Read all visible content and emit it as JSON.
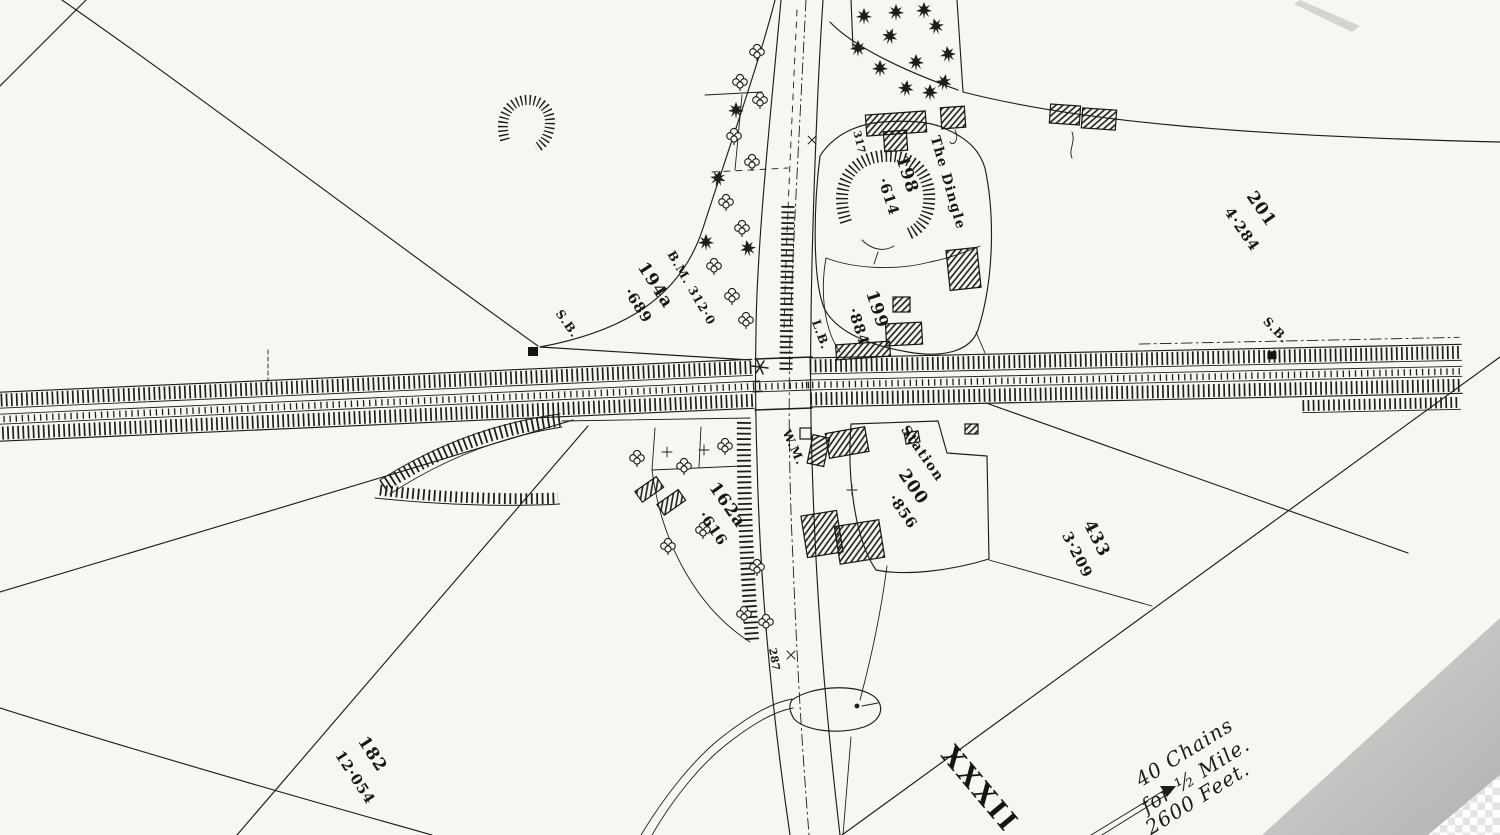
{
  "labels": {
    "dingle_name": "The Dingle",
    "dingle_no": "198",
    "dingle_area": "·614",
    "bench_mark": "B.M. 312·0",
    "p194_no": "194a",
    "p194_area": "·689",
    "sb_left": "S.B.",
    "sb_right": "S.B.",
    "lb": "L.B.",
    "wm": "W.M.",
    "n317": "317",
    "n287": "287",
    "p199_no": "199",
    "p199_area": "·884",
    "p201_no": "201",
    "p201_area": "4·284",
    "station": "Station",
    "p200_no": "200",
    "p200_area": "·856",
    "p433_no": "433",
    "p433_area": "3·209",
    "p162_no": "162a",
    "p162_area": "·616",
    "p182_no": "182",
    "p182_area": "12·054",
    "sheet_no": "XXXII",
    "scale_1": "40 Chains",
    "scale_2": "for ½ Mile.",
    "scale_3": "2600 Feet."
  },
  "colors": {
    "ink": "#1d1d1b",
    "paper": "#f7f6f2",
    "paper_edge_shadow": "#bcbcbc",
    "transparency_checker": "#e4e4e4"
  }
}
